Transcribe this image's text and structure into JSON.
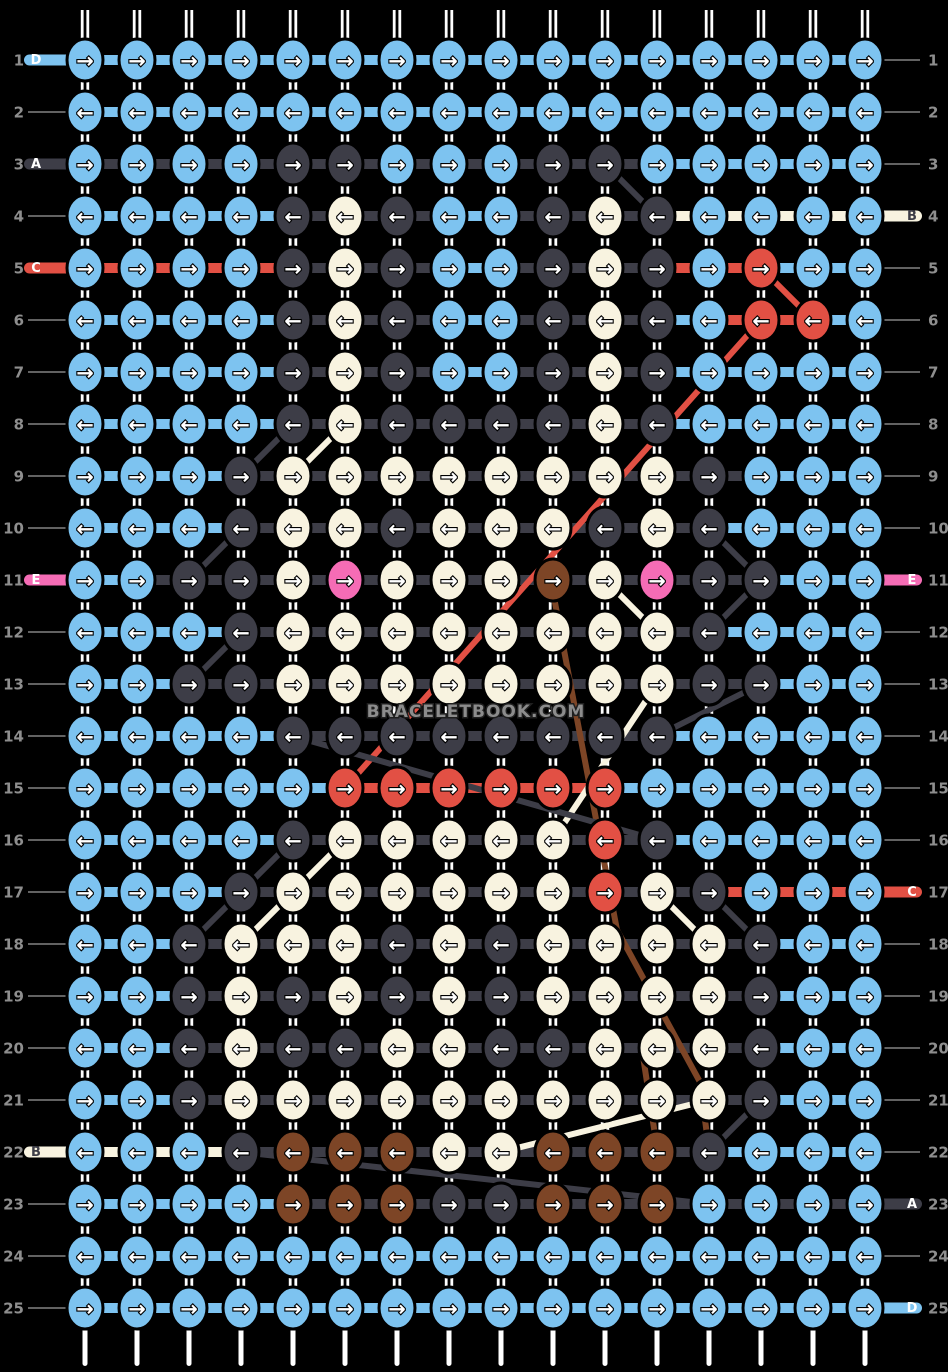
{
  "watermark": "BRACELETBOOK.COM",
  "palette": {
    "B": "#7dc3f0",
    "D": "#3d3d47",
    "C": "#f8f3e0",
    "R": "#e25044",
    "P": "#f56cb5",
    "N": "#7d4526"
  },
  "bg_color": "#000000",
  "string_color": "#ffffff",
  "number_color": "#8e8e8e",
  "thin_line_color": "#7a7a7a",
  "watermark_color": "#8c8c8c",
  "arrows": {
    "right": "→",
    "left": "←"
  },
  "grid": {
    "cols": 16,
    "rows": 25,
    "x0": 85,
    "y0": 60,
    "dx": 52,
    "dy": 52,
    "knot_rx": 18,
    "knot_ry": 21
  },
  "threads": {
    "A": "D",
    "B": "C",
    "C": "R",
    "D": "B",
    "E": "P"
  },
  "rows": [
    {
      "n": 1,
      "dir": "right",
      "knots": "BBBBBBBBBBBBBBBB",
      "segs": "BBBBBBBBBBBBBBB",
      "left": {
        "letter": "D"
      },
      "right": {}
    },
    {
      "n": 2,
      "dir": "left",
      "knots": "BBBBBBBBBBBBBBBB",
      "segs": "BBBBBBBBBBBBBBB",
      "left": {},
      "right": {}
    },
    {
      "n": 3,
      "dir": "right",
      "knots": "BBBBDDBBBDDBBBBB",
      "segs": "DDDDDDDDDDDBBBB",
      "left": {
        "letter": "A"
      },
      "right": {}
    },
    {
      "n": 4,
      "dir": "left",
      "knots": "BBBBDCDBBDCDBBBB",
      "segs": "BBBBDDDBDDDCCCC",
      "left": {},
      "right": {
        "letter": "B"
      }
    },
    {
      "n": 5,
      "dir": "right",
      "knots": "BBBBDCDBBDCDBRBB",
      "segs": "RRRRDDDBDDDRRBB",
      "left": {
        "letter": "C"
      },
      "right": {}
    },
    {
      "n": 6,
      "dir": "left",
      "knots": "BBBBDCDBBDCDBRRB",
      "segs": "BBBBDDDBDDDBRRB",
      "left": {},
      "right": {}
    },
    {
      "n": 7,
      "dir": "right",
      "knots": "BBBBDCDBBDCDBBBB",
      "segs": "BBBBDDDBDDDBBBB",
      "left": {},
      "right": {}
    },
    {
      "n": 8,
      "dir": "left",
      "knots": "BBBBDCDDDDCDBBBB",
      "segs": "BBBBDDDDDDDBBBB",
      "left": {},
      "right": {}
    },
    {
      "n": 9,
      "dir": "right",
      "knots": "BBBDCCCCCCCCDBBB",
      "segs": "BBBDDDDDDDDDDBB",
      "left": {},
      "right": {}
    },
    {
      "n": 10,
      "dir": "left",
      "knots": "BBBDCCDCCCDCDBBB",
      "segs": "BBBDDDDDDDDDBBB",
      "left": {},
      "right": {}
    },
    {
      "n": 11,
      "dir": "right",
      "knots": "BBDDCPCCCNCPDDBB",
      "segs": "BDDDDDDDDDDDDBB",
      "left": {
        "letter": "E"
      },
      "right": {
        "letter": "E"
      }
    },
    {
      "n": 12,
      "dir": "left",
      "knots": "BBBDCCCCCCCCDBBB",
      "segs": "BBBDDDDDDDDDBBB",
      "left": {},
      "right": {}
    },
    {
      "n": 13,
      "dir": "right",
      "knots": "BBDDCCCCCCCCDDBB",
      "segs": "BBDDDDDDDDDDDBB",
      "left": {},
      "right": {}
    },
    {
      "n": 14,
      "dir": "left",
      "knots": "BBBBDDDDDDDDBBBB",
      "segs": "BBBBDDDDDDDBBBB",
      "left": {},
      "right": {}
    },
    {
      "n": 15,
      "dir": "right",
      "knots": "BBBBBRRRRRRBBBBB",
      "segs": "BBBBBRRRRRBBBBB",
      "left": {},
      "right": {}
    },
    {
      "n": 16,
      "dir": "left",
      "knots": "BBBBDCCCCCRDBBBB",
      "segs": "BBBBDDDDDDDBBBB",
      "left": {},
      "right": {}
    },
    {
      "n": 17,
      "dir": "right",
      "knots": "BBBDCCCCCCRCDBBB",
      "segs": "BBBDDDDDDDDDRRR",
      "left": {},
      "right": {
        "letter": "C"
      }
    },
    {
      "n": 18,
      "dir": "left",
      "knots": "BBDCCCDCDCCCCDBB",
      "segs": "BBDDDDDDDDDDDBB",
      "left": {},
      "right": {}
    },
    {
      "n": 19,
      "dir": "right",
      "knots": "BBDCDCDCDCCCCDBB",
      "segs": "BBDDDDDDDDDDDBB",
      "left": {},
      "right": {}
    },
    {
      "n": 20,
      "dir": "left",
      "knots": "BBDCDDCCDDCCCDBB",
      "segs": "BBDDDDDDDDDDDBB",
      "left": {},
      "right": {}
    },
    {
      "n": 21,
      "dir": "right",
      "knots": "BBDCCCCCCCCCCDBB",
      "segs": "BBDDDDDDDDDDDBB",
      "left": {},
      "right": {}
    },
    {
      "n": 22,
      "dir": "left",
      "knots": "BBBDNNNCCNNNDBBB",
      "segs": "CCCDDDDDDDDDBBB",
      "left": {
        "letter": "B"
      },
      "right": {}
    },
    {
      "n": 23,
      "dir": "right",
      "knots": "BBBBNNNDDNNNBBBB",
      "segs": "BBBBDDDDDDDDDDD",
      "left": {},
      "right": {
        "letter": "A"
      }
    },
    {
      "n": 24,
      "dir": "left",
      "knots": "BBBBBBBBBBBBBBBB",
      "segs": "BBBBBBBBBBBBBBB",
      "left": {},
      "right": {}
    },
    {
      "n": 25,
      "dir": "right",
      "knots": "BBBBBBBBBBBBBBBB",
      "segs": "BBBBBBBBBBBBBBB",
      "left": {},
      "right": {
        "letter": "D"
      }
    }
  ],
  "carry_lines": [
    {
      "color": "D",
      "points": [
        [
          605,
          164
        ],
        [
          657,
          216
        ]
      ]
    },
    {
      "color": "R",
      "points": [
        [
          761,
          268
        ],
        [
          813,
          320
        ]
      ]
    },
    {
      "color": "R",
      "points": [
        [
          761,
          320
        ],
        [
          345,
          788
        ]
      ]
    },
    {
      "color": "D",
      "points": [
        [
          293,
          424
        ],
        [
          241,
          476
        ]
      ]
    },
    {
      "color": "C",
      "points": [
        [
          345,
          424
        ],
        [
          293,
          476
        ]
      ]
    },
    {
      "color": "D",
      "points": [
        [
          241,
          528
        ],
        [
          189,
          580
        ]
      ]
    },
    {
      "color": "D",
      "points": [
        [
          709,
          528
        ],
        [
          761,
          580
        ]
      ]
    },
    {
      "color": "D",
      "points": [
        [
          241,
          632
        ],
        [
          189,
          684
        ]
      ]
    },
    {
      "color": "C",
      "points": [
        [
          605,
          580
        ],
        [
          657,
          632
        ]
      ]
    },
    {
      "color": "D",
      "points": [
        [
          761,
          580
        ],
        [
          709,
          632
        ]
      ]
    },
    {
      "color": "N",
      "points": [
        [
          553,
          592
        ],
        [
          617,
          930
        ],
        [
          700,
          1082
        ],
        [
          709,
          1150
        ]
      ]
    },
    {
      "color": "N",
      "points": [
        [
          643,
          1056
        ],
        [
          657,
          1148
        ]
      ]
    },
    {
      "color": "D",
      "points": [
        [
          761,
          684
        ],
        [
          657,
          736
        ]
      ]
    },
    {
      "color": "C",
      "points": [
        [
          657,
          684
        ],
        [
          553,
          840
        ]
      ]
    },
    {
      "color": "D",
      "points": [
        [
          293,
          736
        ],
        [
          657,
          840
        ]
      ]
    },
    {
      "color": "D",
      "points": [
        [
          293,
          840
        ],
        [
          241,
          892
        ]
      ]
    },
    {
      "color": "C",
      "points": [
        [
          345,
          840
        ],
        [
          293,
          892
        ]
      ]
    },
    {
      "color": "D",
      "points": [
        [
          241,
          892
        ],
        [
          189,
          944
        ]
      ]
    },
    {
      "color": "C",
      "points": [
        [
          293,
          892
        ],
        [
          241,
          944
        ]
      ]
    },
    {
      "color": "C",
      "points": [
        [
          657,
          892
        ],
        [
          709,
          944
        ]
      ]
    },
    {
      "color": "D",
      "points": [
        [
          709,
          892
        ],
        [
          761,
          944
        ]
      ]
    },
    {
      "color": "D",
      "points": [
        [
          761,
          1100
        ],
        [
          709,
          1152
        ]
      ]
    },
    {
      "color": "C",
      "points": [
        [
          501,
          1152
        ],
        [
          709,
          1100
        ]
      ]
    },
    {
      "color": "D",
      "points": [
        [
          241,
          1152
        ],
        [
          709,
          1204
        ]
      ]
    }
  ]
}
